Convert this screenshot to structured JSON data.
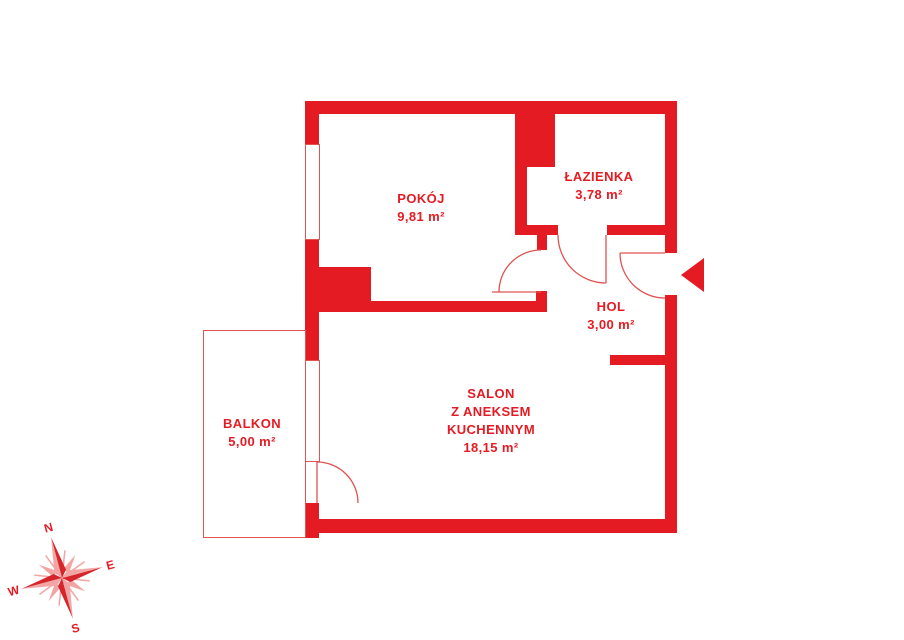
{
  "plan": {
    "type": "apartment-floor-plan",
    "colors": {
      "wall_red": "#e41b22",
      "thin_line_red": "#df5350",
      "compass_light": "#f2a5a3",
      "background": "#ffffff"
    },
    "rooms": [
      {
        "id": "pokoj",
        "name_lines": [
          "POKÓJ"
        ],
        "area": "9,81 m²"
      },
      {
        "id": "lazienka",
        "name_lines": [
          "ŁAZIENKA"
        ],
        "area": "3,78 m²"
      },
      {
        "id": "hol",
        "name_lines": [
          "HOL"
        ],
        "area": "3,00 m²"
      },
      {
        "id": "salon",
        "name_lines": [
          "SALON",
          "Z ANEKSEM",
          "KUCHENNYM"
        ],
        "area": "18,15 m²"
      },
      {
        "id": "balkon",
        "name_lines": [
          "BALKON"
        ],
        "area": "5,00 m²"
      }
    ],
    "compass": {
      "north": "N",
      "east": "E",
      "south": "S",
      "west": "W"
    }
  }
}
